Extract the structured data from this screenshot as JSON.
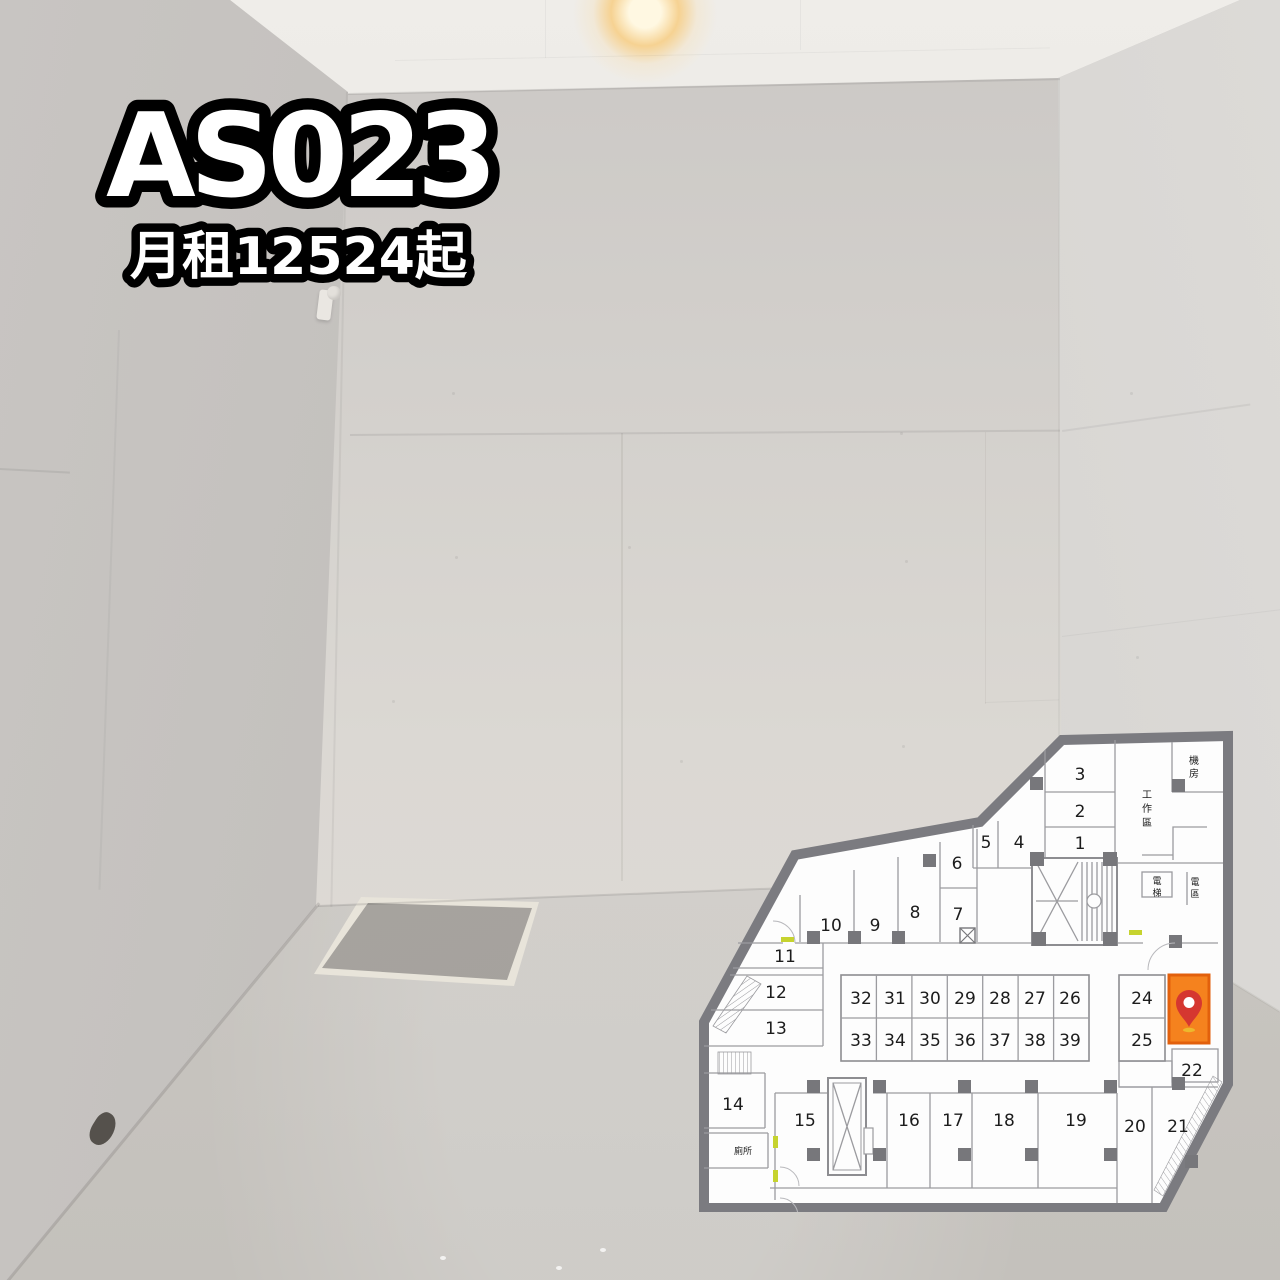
{
  "listing": {
    "unit_code": "AS023",
    "price_line": "月租12524起"
  },
  "floorplan": {
    "units": [
      {
        "n": "1",
        "x": 385,
        "y": 113
      },
      {
        "n": "2",
        "x": 385,
        "y": 81
      },
      {
        "n": "3",
        "x": 385,
        "y": 44
      },
      {
        "n": "4",
        "x": 324,
        "y": 112
      },
      {
        "n": "5",
        "x": 291,
        "y": 112
      },
      {
        "n": "6",
        "x": 262,
        "y": 133
      },
      {
        "n": "7",
        "x": 263,
        "y": 184
      },
      {
        "n": "8",
        "x": 220,
        "y": 182
      },
      {
        "n": "9",
        "x": 180,
        "y": 195
      },
      {
        "n": "10",
        "x": 136,
        "y": 195
      },
      {
        "n": "11",
        "x": 90,
        "y": 226
      },
      {
        "n": "12",
        "x": 81,
        "y": 262
      },
      {
        "n": "13",
        "x": 81,
        "y": 298
      },
      {
        "n": "14",
        "x": 38,
        "y": 374
      },
      {
        "n": "15",
        "x": 110,
        "y": 390
      },
      {
        "n": "16",
        "x": 214,
        "y": 390
      },
      {
        "n": "17",
        "x": 258,
        "y": 390
      },
      {
        "n": "18",
        "x": 309,
        "y": 390
      },
      {
        "n": "19",
        "x": 381,
        "y": 390
      },
      {
        "n": "20",
        "x": 440,
        "y": 396
      },
      {
        "n": "21",
        "x": 483,
        "y": 396
      },
      {
        "n": "22",
        "x": 497,
        "y": 340
      },
      {
        "n": "24",
        "x": 447,
        "y": 268
      },
      {
        "n": "25",
        "x": 447,
        "y": 310
      },
      {
        "n": "26",
        "x": 375,
        "y": 268
      },
      {
        "n": "27",
        "x": 340,
        "y": 268
      },
      {
        "n": "28",
        "x": 305,
        "y": 268
      },
      {
        "n": "29",
        "x": 270,
        "y": 268
      },
      {
        "n": "30",
        "x": 235,
        "y": 268
      },
      {
        "n": "31",
        "x": 200,
        "y": 268
      },
      {
        "n": "32",
        "x": 166,
        "y": 268
      },
      {
        "n": "33",
        "x": 166,
        "y": 310
      },
      {
        "n": "34",
        "x": 200,
        "y": 310
      },
      {
        "n": "35",
        "x": 235,
        "y": 310
      },
      {
        "n": "36",
        "x": 270,
        "y": 310
      },
      {
        "n": "37",
        "x": 305,
        "y": 310
      },
      {
        "n": "38",
        "x": 340,
        "y": 310
      },
      {
        "n": "39",
        "x": 375,
        "y": 310
      }
    ],
    "areas": [
      {
        "t": "機房",
        "x": 499,
        "y": 34,
        "dy": 13,
        "s": 10,
        "v": true
      },
      {
        "t": "工作區",
        "x": 452,
        "y": 68,
        "dy": 14,
        "s": 10,
        "v": true
      },
      {
        "t": "電梯",
        "x": 462,
        "y": 154,
        "dy": 12,
        "s": 9,
        "v": true
      },
      {
        "t": "電區",
        "x": 500,
        "y": 155,
        "dy": 12,
        "s": 9,
        "v": true
      },
      {
        "t": "廁所",
        "x": 48,
        "y": 424,
        "dy": 0,
        "s": 9,
        "v": false
      }
    ],
    "highlight_fill": "#f5821e",
    "highlight_border": "#e2600c",
    "pin_red": "#d53730",
    "pin_shadow": "#ecb82d",
    "wall_grey": "#7b7b80",
    "door_marker_lime": "#c6d32f"
  }
}
